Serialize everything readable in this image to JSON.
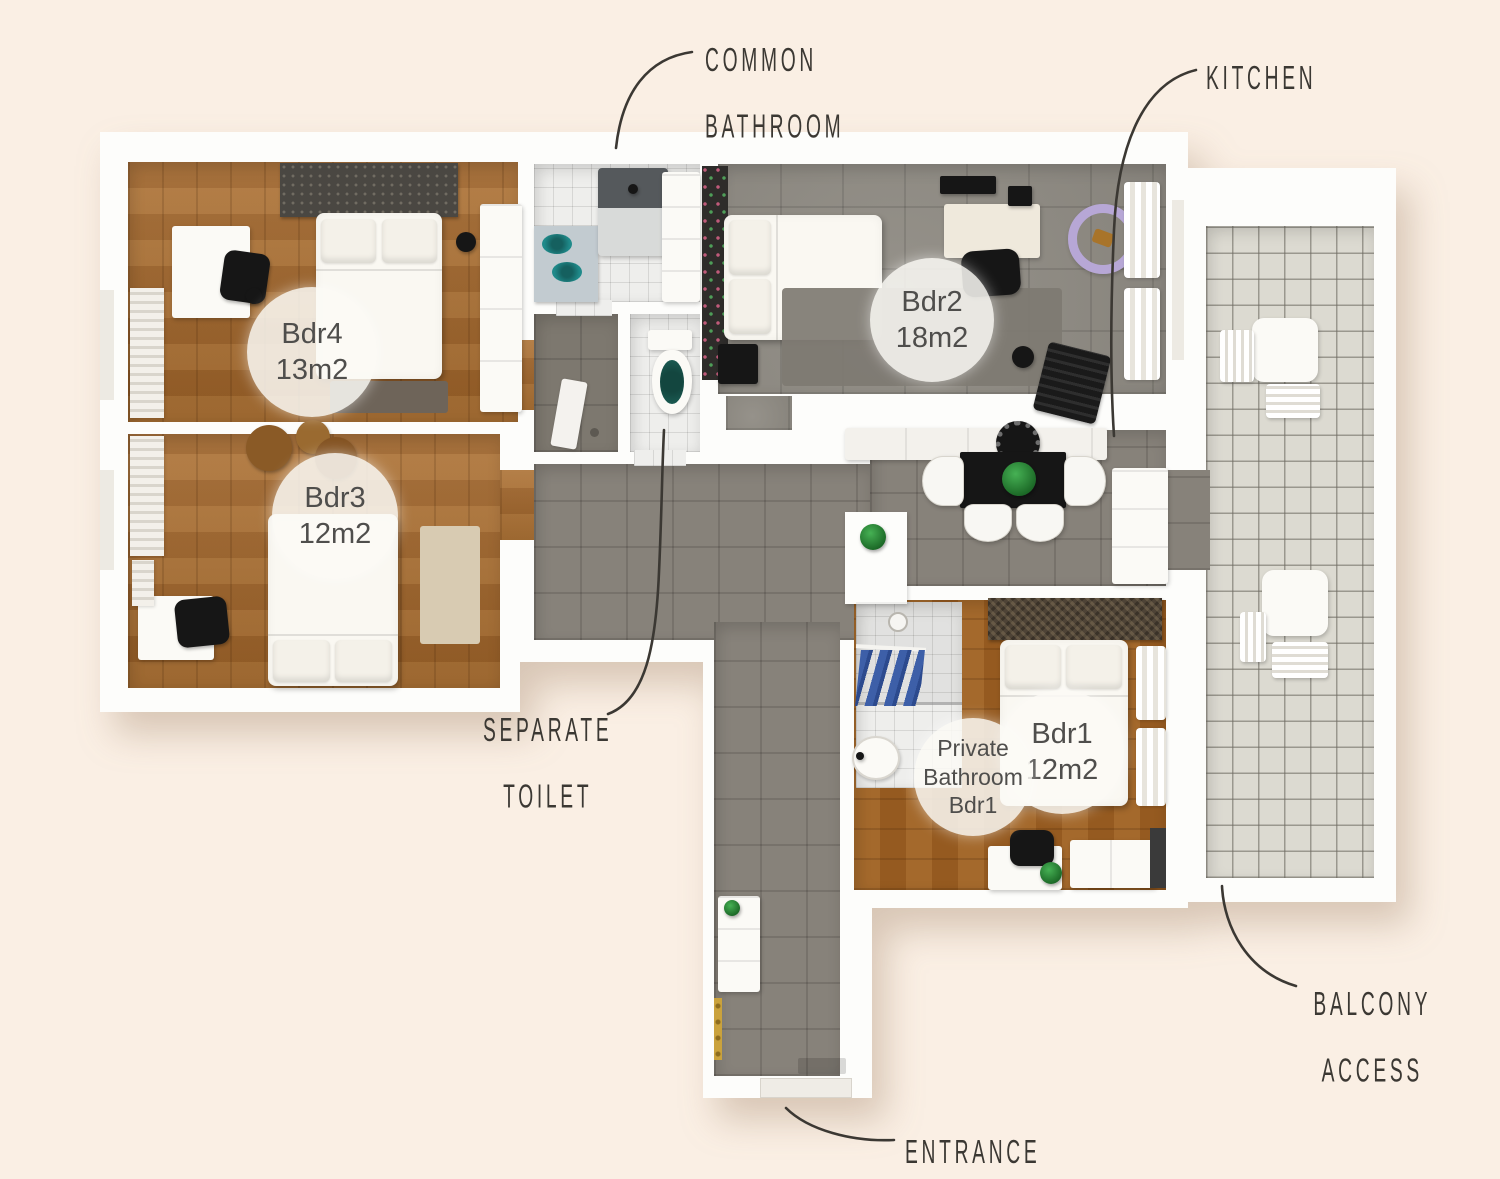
{
  "title": "Apartment floor plan",
  "room_labels": {
    "bdr4": {
      "title": "Bdr4",
      "area": "13m2"
    },
    "bdr3": {
      "title": "Bdr3",
      "area": "12m2"
    },
    "bdr2": {
      "title": "Bdr2",
      "area": "18m2"
    },
    "bdr1": {
      "title": "Bdr1",
      "area": "12m2"
    },
    "private_bathroom": {
      "lines": [
        "Private",
        "Bathroom",
        "Bdr1"
      ]
    }
  },
  "annotations": {
    "common_bathroom": {
      "lines": [
        "COMMON",
        "BATHROOM"
      ]
    },
    "kitchen": {
      "lines": [
        "KITCHEN"
      ]
    },
    "separate_toilet": {
      "lines": [
        "SEPARATE",
        "TOILET"
      ]
    },
    "balcony_access": {
      "lines": [
        "BALCONY",
        "ACCESS"
      ]
    },
    "entrance": {
      "lines": [
        "ENTRANCE"
      ]
    }
  },
  "colors": {
    "background": "#FAEFE4",
    "wall": "#FDFDFB",
    "wood_floor": "#A5682B",
    "wood_floor_dark": "#9C5F22",
    "hallway_tile": "#87827A",
    "bedroom2_tile": "#8F8B83",
    "balcony_tile": "#DCDAD1",
    "bathroom_tile": "#EEEEEC",
    "annotation_text": "#3B3833",
    "label_text": "#4F4E4C",
    "sink_teal": "#1F8A8A",
    "towel_blue": "#3D5FA8",
    "chair_purple": "#B7A7D6",
    "plant_green": "#2F8F3A",
    "coat_rack_gold": "#CAA23C"
  }
}
